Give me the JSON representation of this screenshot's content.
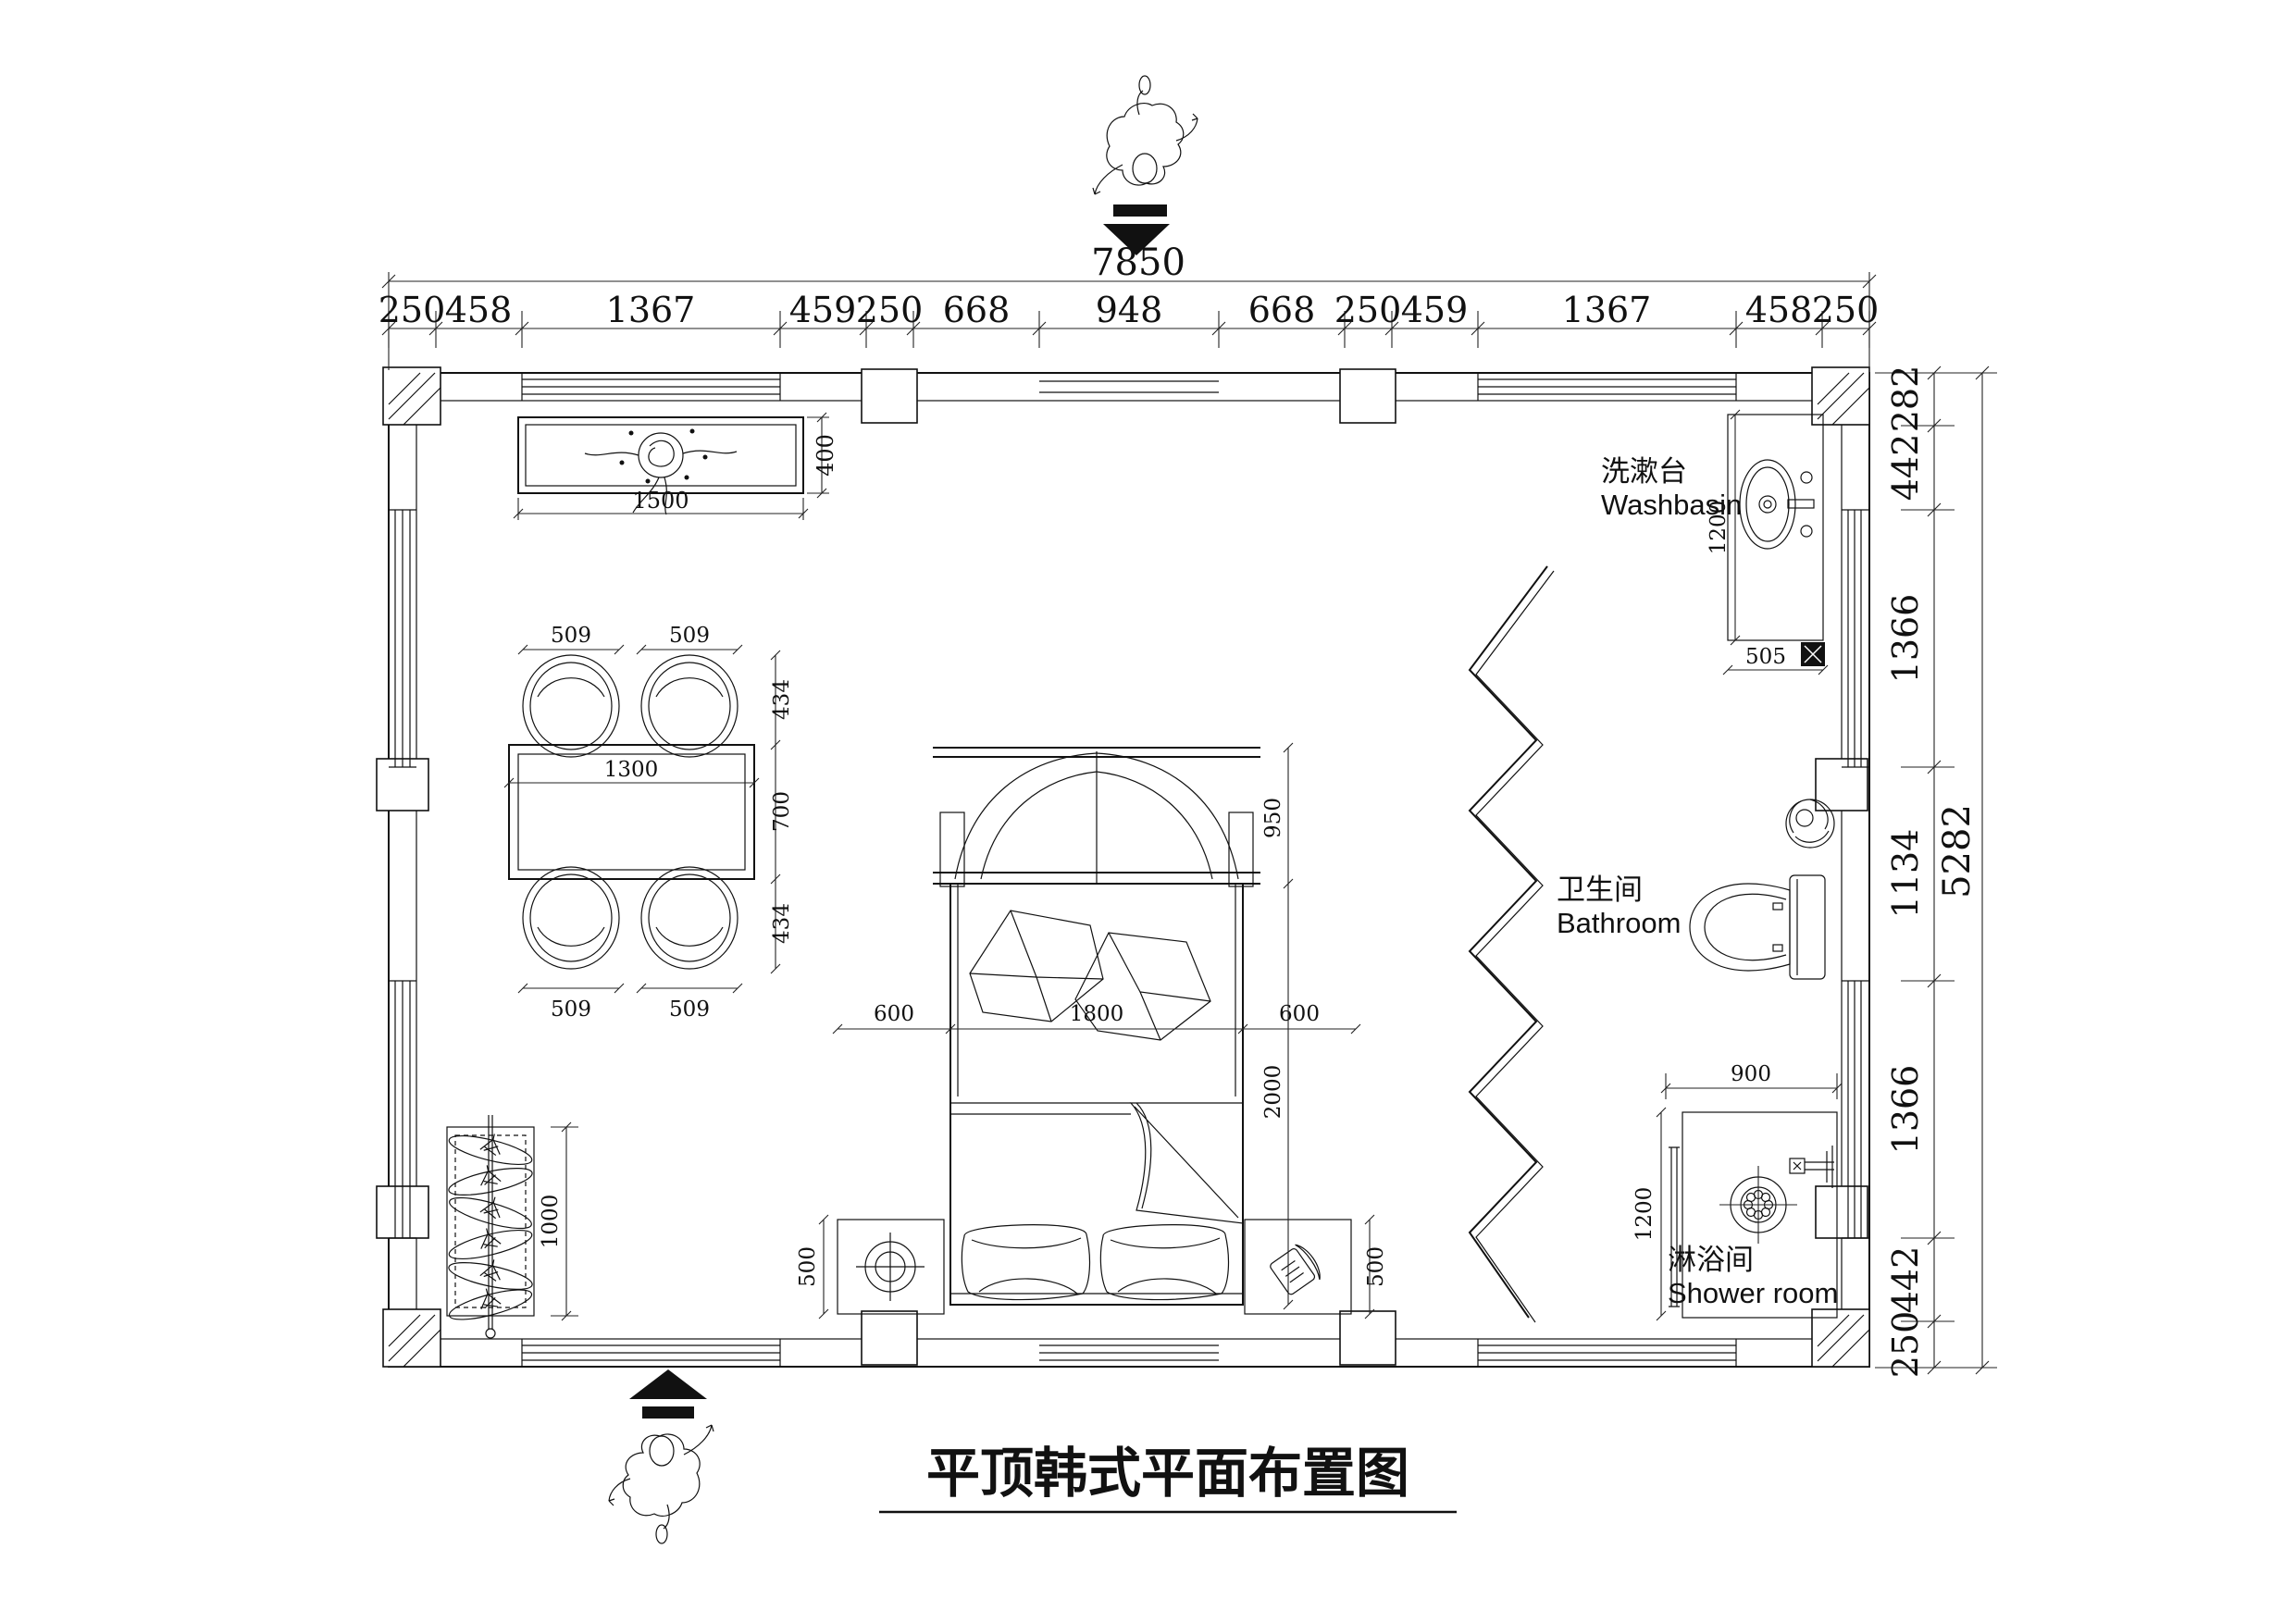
{
  "title": "平顶韩式平面布置图",
  "labels": {
    "washbasin_zh": "洗漱台",
    "washbasin_en": "Washbasin",
    "bathroom_zh": "卫生间",
    "bathroom_en": "Bathroom",
    "shower_zh": "淋浴间",
    "shower_en": "Shower room"
  },
  "dims": {
    "overall_width": "7850",
    "overall_height": "5282",
    "top_row": [
      "250",
      "458",
      "1367",
      "459",
      "250",
      "668",
      "948",
      "668",
      "250",
      "459",
      "1367",
      "458",
      "250"
    ],
    "right_col": [
      "282",
      "442",
      "1366",
      "1134",
      "1366",
      "442",
      "250"
    ]
  },
  "furniture": {
    "tv_cabinet": {
      "width": "1500",
      "depth": "400"
    },
    "dining": {
      "chair_tl": "509",
      "chair_tr": "509",
      "chair_bl": "509",
      "chair_br": "509",
      "depth_top": "434",
      "table_depth": "700",
      "depth_bottom": "434",
      "table_width": "1300"
    },
    "wardrobe": {
      "length": "1000"
    },
    "bed": {
      "left_stand": "600",
      "width": "1800",
      "right_stand": "600",
      "length": "2000",
      "headboard": "950",
      "stand_left_depth": "500",
      "stand_right_depth": "500"
    },
    "washbasin": {
      "length": "1200",
      "width": "505"
    },
    "shower": {
      "width": "900",
      "depth": "1200"
    }
  }
}
